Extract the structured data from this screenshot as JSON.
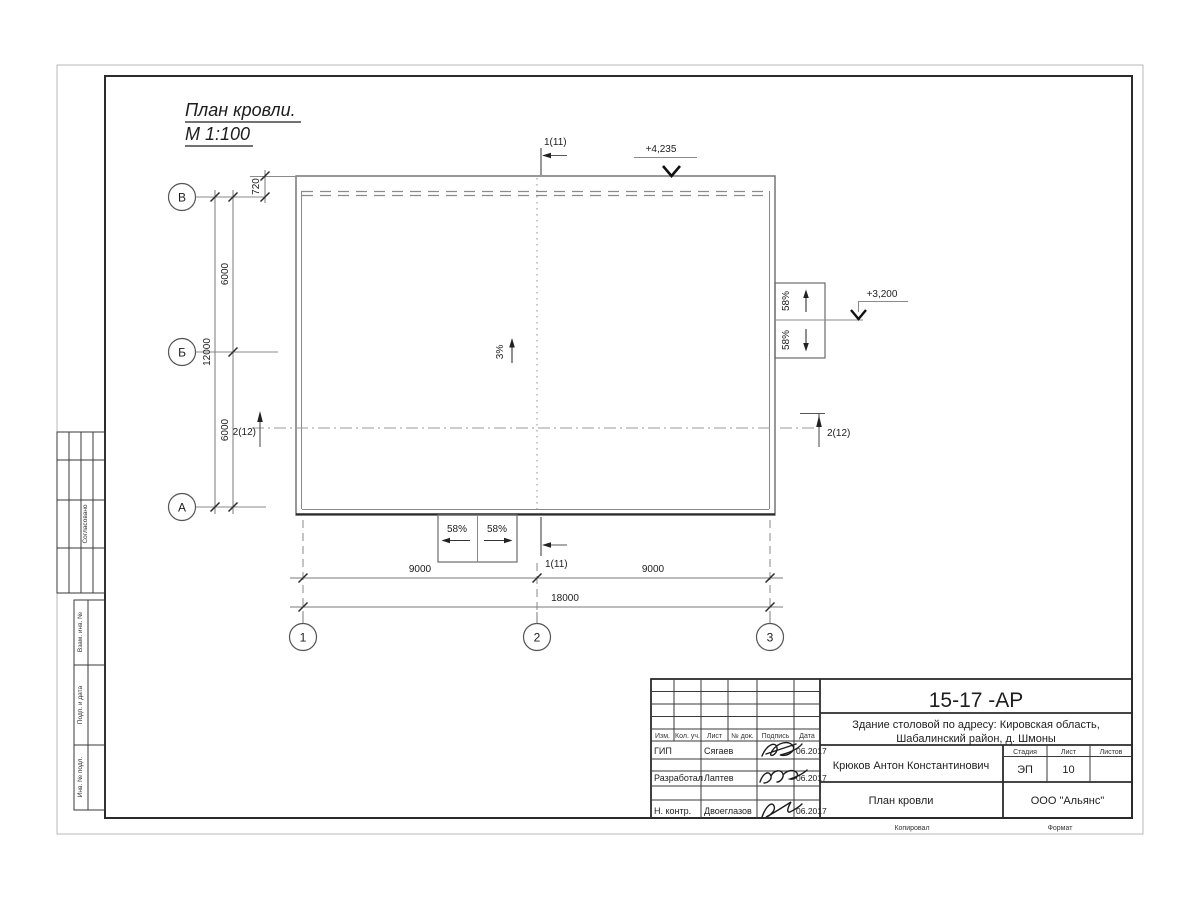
{
  "drawing": {
    "title_line1": "План кровли.",
    "title_line2": "М 1:100",
    "slope_main": "3%",
    "slope_canopy": "58%",
    "elev_top": "+4,235",
    "elev_right": "+3,200",
    "section_1": "1(11)",
    "section_2": "2(12)",
    "dim_720": "720",
    "dim_6000": "6000",
    "dim_12000": "12000",
    "dim_9000": "9000",
    "dim_18000": "18000",
    "axis_rows": [
      "В",
      "Б",
      "А"
    ],
    "axis_cols": [
      "1",
      "2",
      "3"
    ]
  },
  "titleblock": {
    "doc_number": "15-17 -АР",
    "project_line1": "Здание столовой по адресу: Кировская область,",
    "project_line2": "Шабалинский район, д. Шмоны",
    "cols": {
      "izm": "Изм.",
      "kol": "Кол. уч.",
      "list": "Лист",
      "doc": "№ док.",
      "sign": "Подпись",
      "date": "Дата"
    },
    "rows": [
      {
        "role": "ГИП",
        "name": "Сягаев",
        "date": "06.2017"
      },
      {
        "role": "Разработал",
        "name": "Лаптев",
        "date": "06.2017"
      },
      {
        "role": "Н. контр.",
        "name": "Двоеглазов",
        "date": "06.2017"
      }
    ],
    "author": "Крюков Антон Константинович",
    "sheet_name": "План кровли",
    "stage_label": "Стадия",
    "stage_value": "ЭП",
    "sheet_label": "Лист",
    "sheet_value": "10",
    "sheets_label": "Листов",
    "company": "ООО \"Альянс\"",
    "copied": "Копировал",
    "format": "Формат"
  },
  "margin": {
    "agreed": "Согласовано",
    "box1": "Взам. инв. №",
    "box2": "Подп. и дата",
    "box3": "Инв. № подл."
  }
}
